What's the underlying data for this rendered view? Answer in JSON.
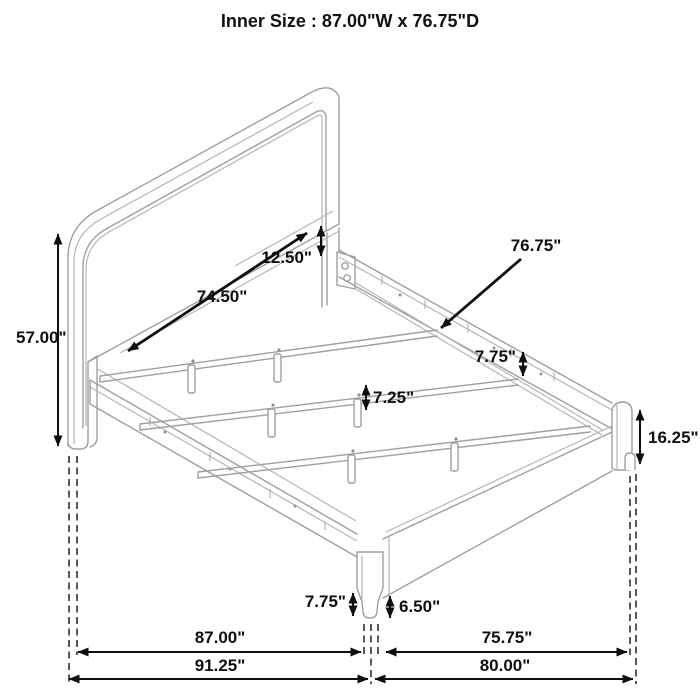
{
  "title": "Inner Size : 87.00\"W x 76.75\"D",
  "dims": {
    "headboard_inner_width": {
      "label": "74.50\""
    },
    "panel_to_rail_gap": {
      "label": "12.50\""
    },
    "rail_inner_depth": {
      "label": "76.75\""
    },
    "headboard_height": {
      "label": "57.00\""
    },
    "rail_top_drop": {
      "label": "7.75\""
    },
    "support_leg_height": {
      "label": "7.25\""
    },
    "rail_floor_clearance": {
      "label": "7.75\""
    },
    "front_leg_height": {
      "label": "6.50\""
    },
    "footboard_corner_height": {
      "label": "16.25\""
    },
    "width_between_legs": {
      "label": "87.00\""
    },
    "overall_width": {
      "label": "91.25\""
    },
    "depth_between_legs": {
      "label": "75.75\""
    },
    "overall_depth": {
      "label": "80.00\""
    }
  },
  "colors": {
    "furniture_line": "#9d9fa2",
    "dimension": "#0f0f0f",
    "dashed_reference": "#474747",
    "background": "#ffffff"
  }
}
